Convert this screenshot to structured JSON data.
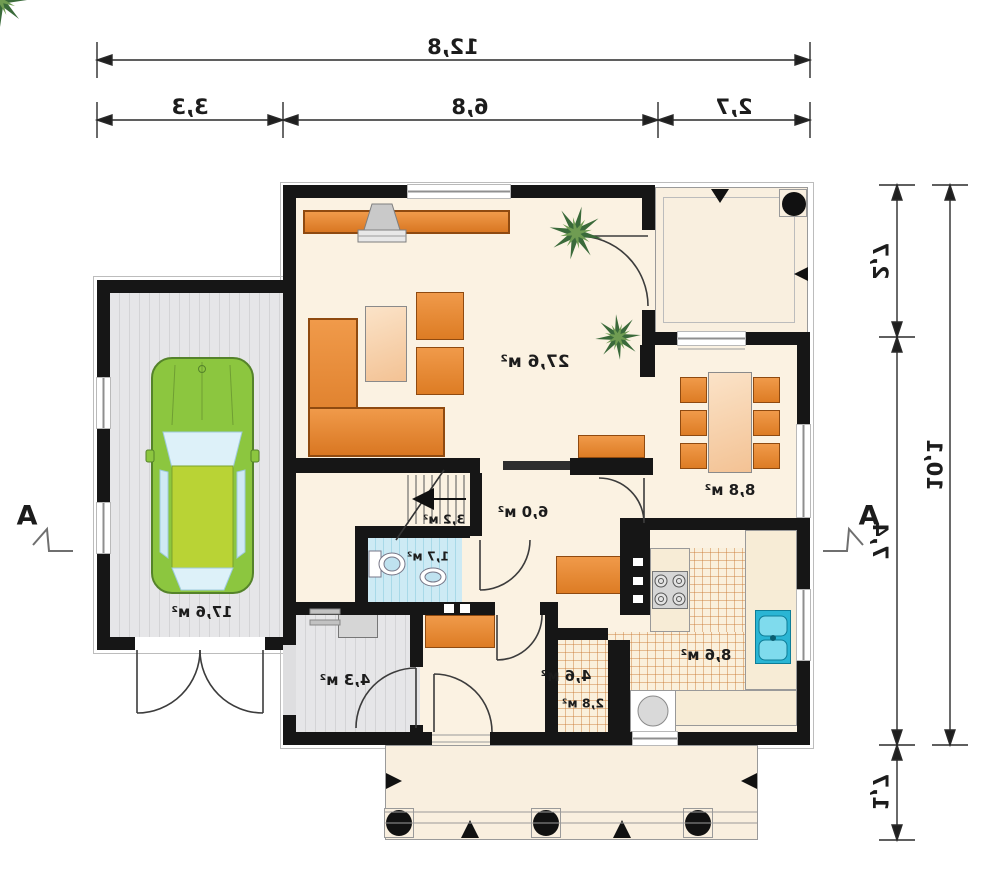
{
  "plan_title": "first-floor-plan",
  "dimensions": {
    "top_total": "12,8",
    "top_segments": [
      "3,3",
      "6,8",
      "2,7"
    ],
    "right_total": "10,1",
    "right_segments": [
      "2,7",
      "7,4",
      "1,7"
    ]
  },
  "section_markers": {
    "left": "A",
    "right": "A"
  },
  "rooms": {
    "living": "27,6 м²",
    "dining": "8,8 м²",
    "hall": "6,0 м²",
    "stairs": "3,2 м²",
    "wc": "1,7 м²",
    "boiler": "4,3 м²",
    "entry": "4,6 м²",
    "pantry": "2,8 м²",
    "kitchen": "8,6 м²",
    "garage": "17,6 м²"
  },
  "colors": {
    "wall": "#161616",
    "floor": "#fbf2e2",
    "furniture_orange": "#e0802f",
    "table_peach": "#f3c294",
    "car_green": "#8cc63f",
    "sink_blue": "#2ab5d4",
    "wc_tile_blue": "#c3e6f2",
    "garage_gray": "#dcdcde"
  }
}
